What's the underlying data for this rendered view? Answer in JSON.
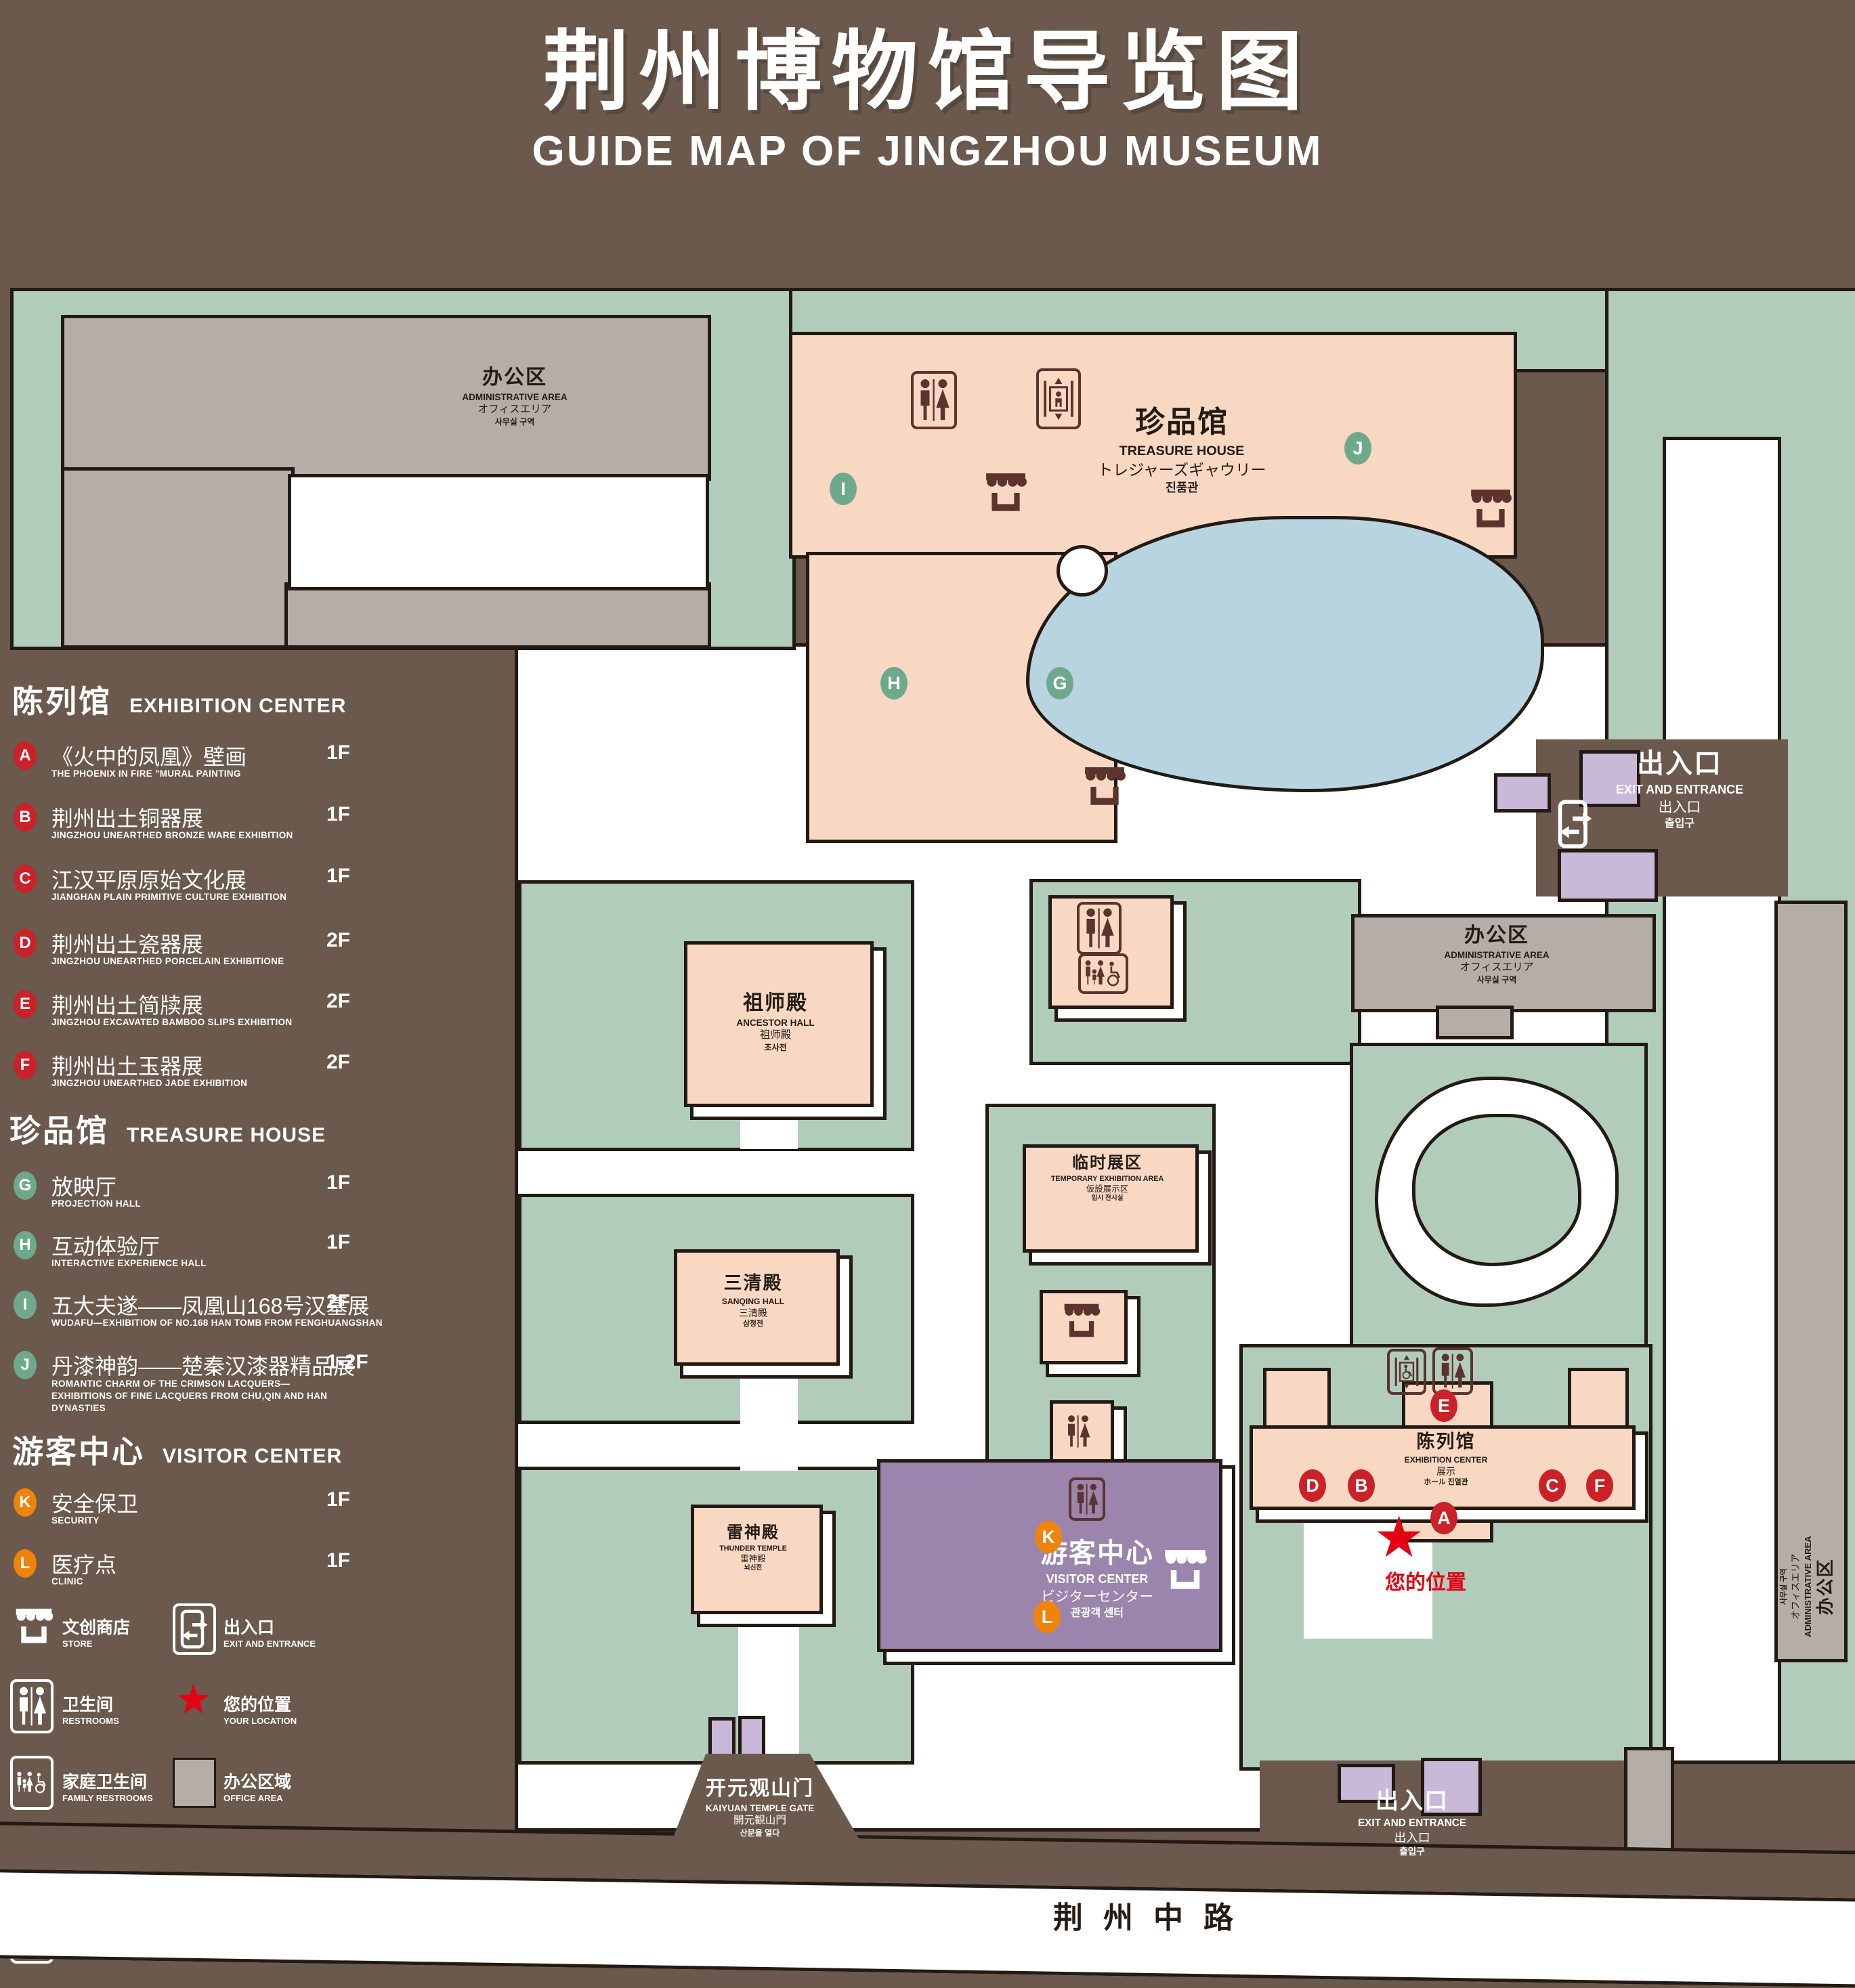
{
  "title": {
    "zh": "荆州博物馆导览图",
    "en": "GUIDE MAP OF JINGZHOU MUSEUM"
  },
  "legend": {
    "sections": [
      {
        "zh": "陈列馆",
        "en": "EXHIBITION CENTER",
        "items": [
          {
            "letter": "A",
            "zh": "《火中的凤凰》壁画",
            "en": "THE PHOENIX IN FIRE \"MURAL PAINTING",
            "floor": "1F"
          },
          {
            "letter": "B",
            "zh": "荆州出土铜器展",
            "en": "JINGZHOU UNEARTHED BRONZE WARE EXHIBITION",
            "floor": "1F"
          },
          {
            "letter": "C",
            "zh": "江汉平原原始文化展",
            "en": "JIANGHAN PLAIN PRIMITIVE CULTURE EXHIBITION",
            "floor": "1F"
          },
          {
            "letter": "D",
            "zh": "荆州出土瓷器展",
            "en": "JINGZHOU UNEARTHED PORCELAIN EXHIBITIONE",
            "floor": "2F"
          },
          {
            "letter": "E",
            "zh": "荆州出土简牍展",
            "en": "JINGZHOU EXCAVATED BAMBOO SLIPS EXHIBITION",
            "floor": "2F"
          },
          {
            "letter": "F",
            "zh": "荆州出土玉器展",
            "en": "JINGZHOU UNEARTHED JADE EXHIBITION",
            "floor": "2F"
          }
        ]
      },
      {
        "zh": "珍品馆",
        "en": "TREASURE HOUSE",
        "items": [
          {
            "letter": "G",
            "zh": "放映厅",
            "en": "PROJECTION HALL",
            "floor": "1F"
          },
          {
            "letter": "H",
            "zh": "互动体验厅",
            "en": "INTERACTIVE EXPERIENCE HALL",
            "floor": "1F"
          },
          {
            "letter": "I",
            "zh": "五大夫遂——凤凰山168号汉墓展",
            "en": "WUDAFU—EXHIBITION OF NO.168 HAN TOMB FROM FENGHUANGSHAN",
            "floor": "2F"
          },
          {
            "letter": "J",
            "zh": "丹漆神韵——楚秦汉漆器精品展",
            "en": "ROMANTIC CHARM OF THE CRIMSON LACQUERS—EXHIBITIONS OF FINE LACQUERS FROM CHU,QIN AND HAN DYNASTIES",
            "floor": "1-2F"
          }
        ]
      },
      {
        "zh": "游客中心",
        "en": "VISITOR CENTER",
        "items": [
          {
            "letter": "K",
            "zh": "安全保卫",
            "en": "SECURITY",
            "floor": "1F"
          },
          {
            "letter": "L",
            "zh": "医疗点",
            "en": "CLINIC",
            "floor": "1F"
          }
        ]
      }
    ],
    "symbols": [
      {
        "zh": "文创商店",
        "en": "STORE"
      },
      {
        "zh": "出入口",
        "en": "EXIT AND ENTRANCE"
      },
      {
        "zh": "卫生间",
        "en": "RESTROOMS"
      },
      {
        "zh": "您的位置",
        "en": "YOUR LOCATION"
      },
      {
        "zh": "家庭卫生间",
        "en": "FAMILY RESTROOMS"
      },
      {
        "zh": "办公区域",
        "en": "OFFICE AREA"
      },
      {
        "zh": "无障碍电梯",
        "en": "ACCESSIBLE ELEVATOR"
      },
      {
        "zh": "展示区域",
        "en": "DISPLAY AREA"
      },
      {
        "zh": "电梯",
        "en": "Elevator"
      }
    ]
  },
  "map": {
    "buildings": {
      "admin_nw": {
        "zh": "办公区",
        "en": "ADMINISTRATIVE AREA",
        "ja": "オフィスエリア",
        "ko": "사무실 구역"
      },
      "treasure_house": {
        "zh": "珍品馆",
        "en": "TREASURE HOUSE",
        "ja": "トレジャーズギャウリー",
        "ko": "진품관"
      },
      "ancestor_hall": {
        "zh": "祖师殿",
        "en": "ANCESTOR HALL",
        "ja": "祖师殿",
        "ko": "조사전"
      },
      "temporary_area": {
        "zh": "临时展区",
        "en": "TEMPORARY EXHIBITION AREA",
        "ja": "仮設展示区",
        "ko": "임시 전시실"
      },
      "admin_mid": {
        "zh": "办公区",
        "en": "ADMINISTRATIVE AREA",
        "ja": "オフィスエリア",
        "ko": "사무실 구역"
      },
      "admin_east": {
        "zh": "办公区",
        "en": "ADMINISTRATIVE AREA",
        "ja": "オフィスエリア",
        "ko": "사무실 구역"
      },
      "sanqing_hall": {
        "zh": "三清殿",
        "en": "SANQING HALL",
        "ja": "三清殿",
        "ko": "삼청전"
      },
      "thunder_temple": {
        "zh": "雷神殿",
        "en": "THUNDER TEMPLE",
        "ja": "雷神殿",
        "ko": "뇌신전"
      },
      "visitor_center": {
        "zh": "游客中心",
        "en": "VISITOR CENTER",
        "ja": "ビジターセンター",
        "ko": "관광객 센터"
      },
      "exhibition_center": {
        "zh": "陈列馆",
        "en": "EXHIBITION CENTER",
        "ja": "展示",
        "ko": "ホール 진열관"
      },
      "gate": {
        "zh": "开元观山门",
        "en": "KAIYUAN TEMPLE GATE",
        "ja": "開元観山門",
        "ko": "산문을 열다"
      },
      "exit_ne": {
        "zh": "出入口",
        "en": "EXIT AND ENTRANCE",
        "ja": "出入口",
        "ko": "출입구"
      },
      "exit_south": {
        "zh": "出入口",
        "en": "EXIT AND ENTRANCE",
        "ja": "出入口",
        "ko": "출입구"
      }
    },
    "road": {
      "name": "荆州中路"
    },
    "your_location": "您的位置",
    "badges": [
      {
        "letter": "I",
        "color": "green"
      },
      {
        "letter": "J",
        "color": "green"
      },
      {
        "letter": "H",
        "color": "green"
      },
      {
        "letter": "G",
        "color": "green"
      },
      {
        "letter": "E",
        "color": "red"
      },
      {
        "letter": "D",
        "color": "red"
      },
      {
        "letter": "B",
        "color": "red"
      },
      {
        "letter": "C",
        "color": "red"
      },
      {
        "letter": "F",
        "color": "red"
      },
      {
        "letter": "A",
        "color": "red"
      },
      {
        "letter": "K",
        "color": "orange"
      },
      {
        "letter": "L",
        "color": "orange"
      }
    ]
  },
  "colors": {
    "background": "#6a594c",
    "landscape_green": "#b2ccbc",
    "display_area_pink": "#f8d8c3",
    "office_area_gray": "#b5aea8",
    "water_blue": "#b7d4e0",
    "visitor_purple": "#9b85ad",
    "light_purple": "#cab8d9",
    "badge_red": "#cb2128",
    "badge_green": "#6fa98c",
    "badge_orange": "#f0830a",
    "star_red": "#e60012",
    "icon_brown": "#5c332d"
  }
}
